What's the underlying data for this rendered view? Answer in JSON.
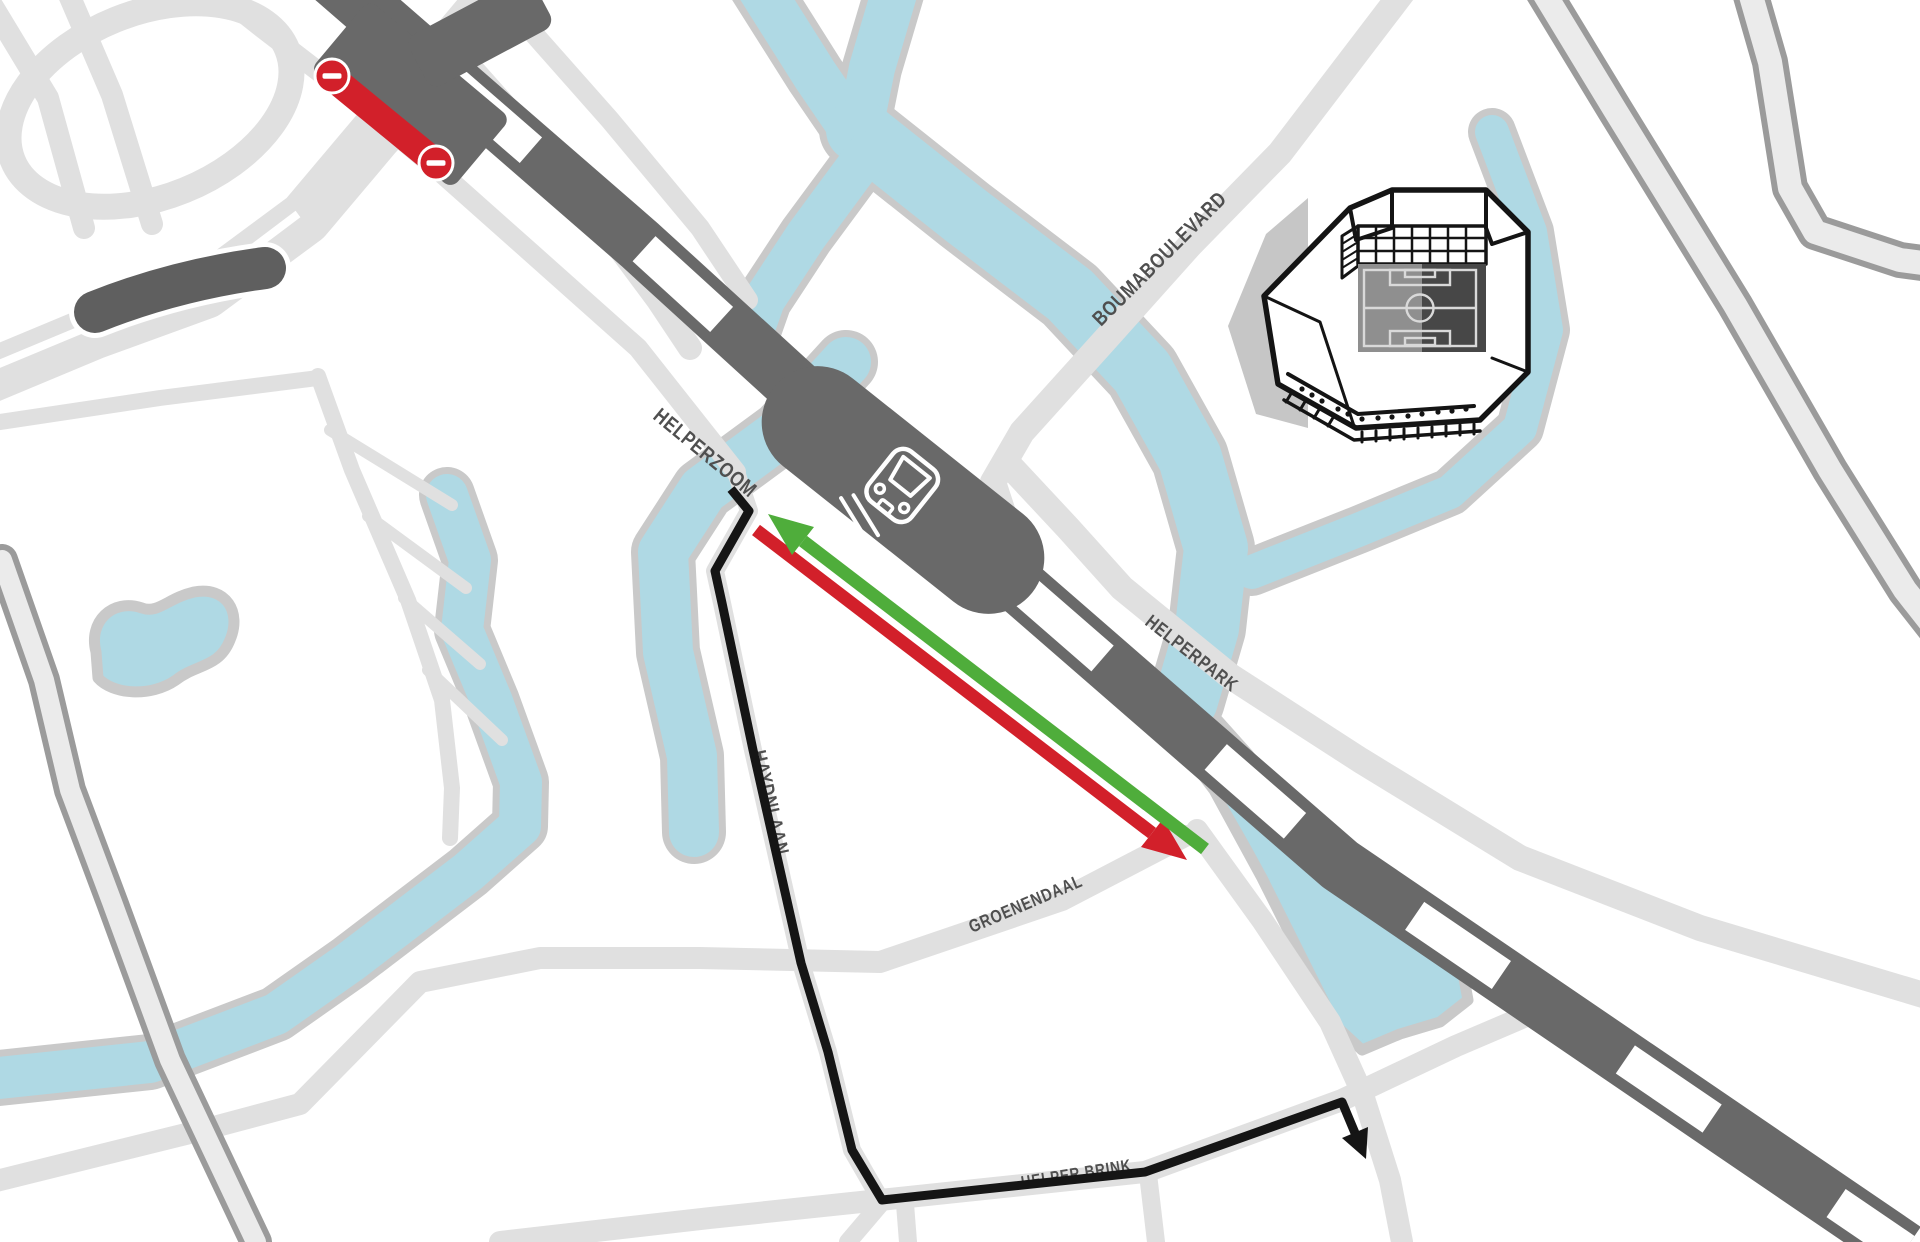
{
  "map": {
    "type": "stylized-route-map",
    "streets": [
      {
        "id": "helperzoom",
        "label": "HELPERZOOM"
      },
      {
        "id": "boumaboulevard",
        "label": "BOUMABOULEVARD"
      },
      {
        "id": "helperpark",
        "label": "HELPERPARK"
      },
      {
        "id": "haydnlaan",
        "label": "HAYDNLAAN"
      },
      {
        "id": "groenendaal",
        "label": "GROENENDAAL"
      },
      {
        "id": "helper-brink",
        "label": "HELPER BRINK"
      }
    ],
    "icons": [
      {
        "name": "train-station-icon"
      },
      {
        "name": "no-entry-icon",
        "count": 2
      },
      {
        "name": "stadium-illustration"
      },
      {
        "name": "green-direction-arrow"
      },
      {
        "name": "red-direction-arrow"
      },
      {
        "name": "walking-route-arrow"
      }
    ],
    "features": {
      "closed_segment": "red bar with two no-entry signs on level crossing",
      "railway": "dashed dark band with station block",
      "route_line": "black polyline with arrowhead"
    }
  },
  "colors": {
    "water": "#afd9e4",
    "water-casing": "#c9c9c9",
    "road": "#e0e0e0",
    "casing-edge": "#9b9b9b",
    "casing-fill": "#ebebeb",
    "railway": "#696969",
    "bridge": "#5f5f5f",
    "red": "#d2202a",
    "green": "#4fad3b",
    "route": "#151515",
    "label": "#4f4f4f",
    "shadow": "#c6c6c6",
    "ink": "#141414",
    "pitch-light": "#8f8f8f",
    "pitch-dark": "#474747"
  }
}
